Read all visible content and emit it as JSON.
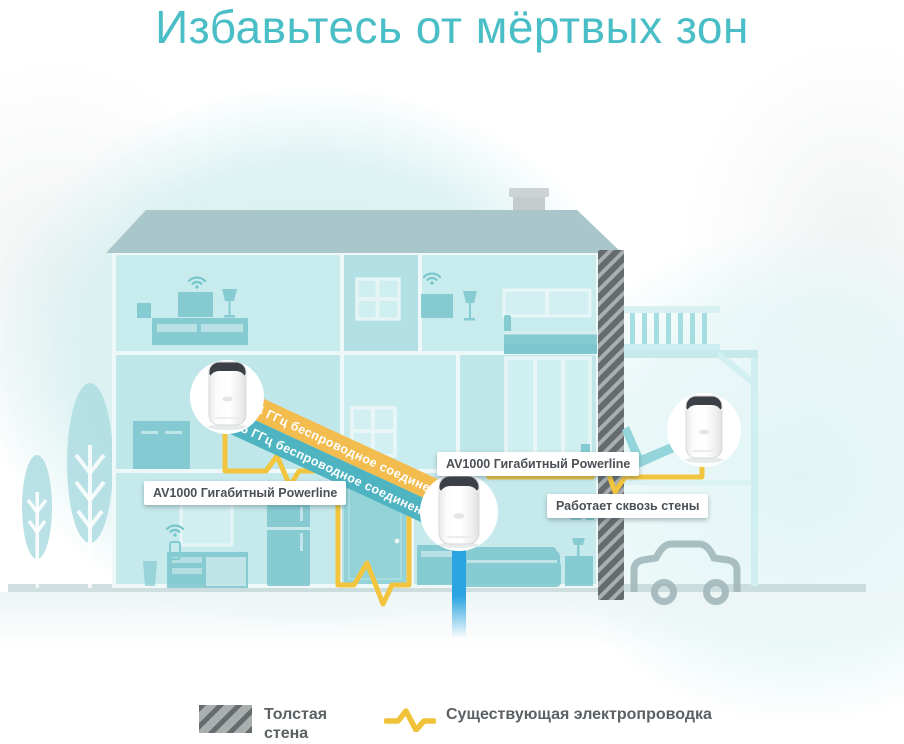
{
  "title": "Избавьтесь от мёртвых зон",
  "diagram": {
    "connection_bands": {
      "band_24ghz": "2.4 ГГц беспроводное соединение",
      "band_5ghz": "5 ГГц беспроводное соединение"
    },
    "callouts": {
      "powerline_left": "AV1000 Гигабитный Powerline",
      "powerline_center": "AV1000 Гигабитный Powerline",
      "through_walls": "Работает сквозь стены"
    },
    "icons": {
      "devices": [
        "mesh-device-icon",
        "mesh-device-icon",
        "mesh-device-icon"
      ],
      "wifi": "wifi-icon",
      "house": "house-cross-section-illustration",
      "car": "car-icon",
      "trees": "tree-icon",
      "thick_wall": "hatched-wall",
      "internet_line": "internet-line",
      "powerline_wire": "powerline-wire-zigzag"
    }
  },
  "legend": {
    "thick_wall_label": "Толстая стена",
    "existing_wiring_label": "Существующая электропроводка",
    "thick_wall_swatch": "hatched-swatch-icon",
    "wiring_swatch": "yellow-zigzag-icon"
  },
  "colors": {
    "title_teal": "#4BBFC7",
    "band_24ghz_yellow": "#F3BC4E",
    "band_5ghz_teal": "#4FB4C1",
    "powerline_yellow": "#F3C53E",
    "internet_blue": "#2AA5E2",
    "house_teal": "#BFE6E9",
    "wall_gray": "#A9AEAE",
    "wall_stripe_dark": "#666C6E",
    "label_text": "#4A5055",
    "legend_text": "#5C6164"
  }
}
